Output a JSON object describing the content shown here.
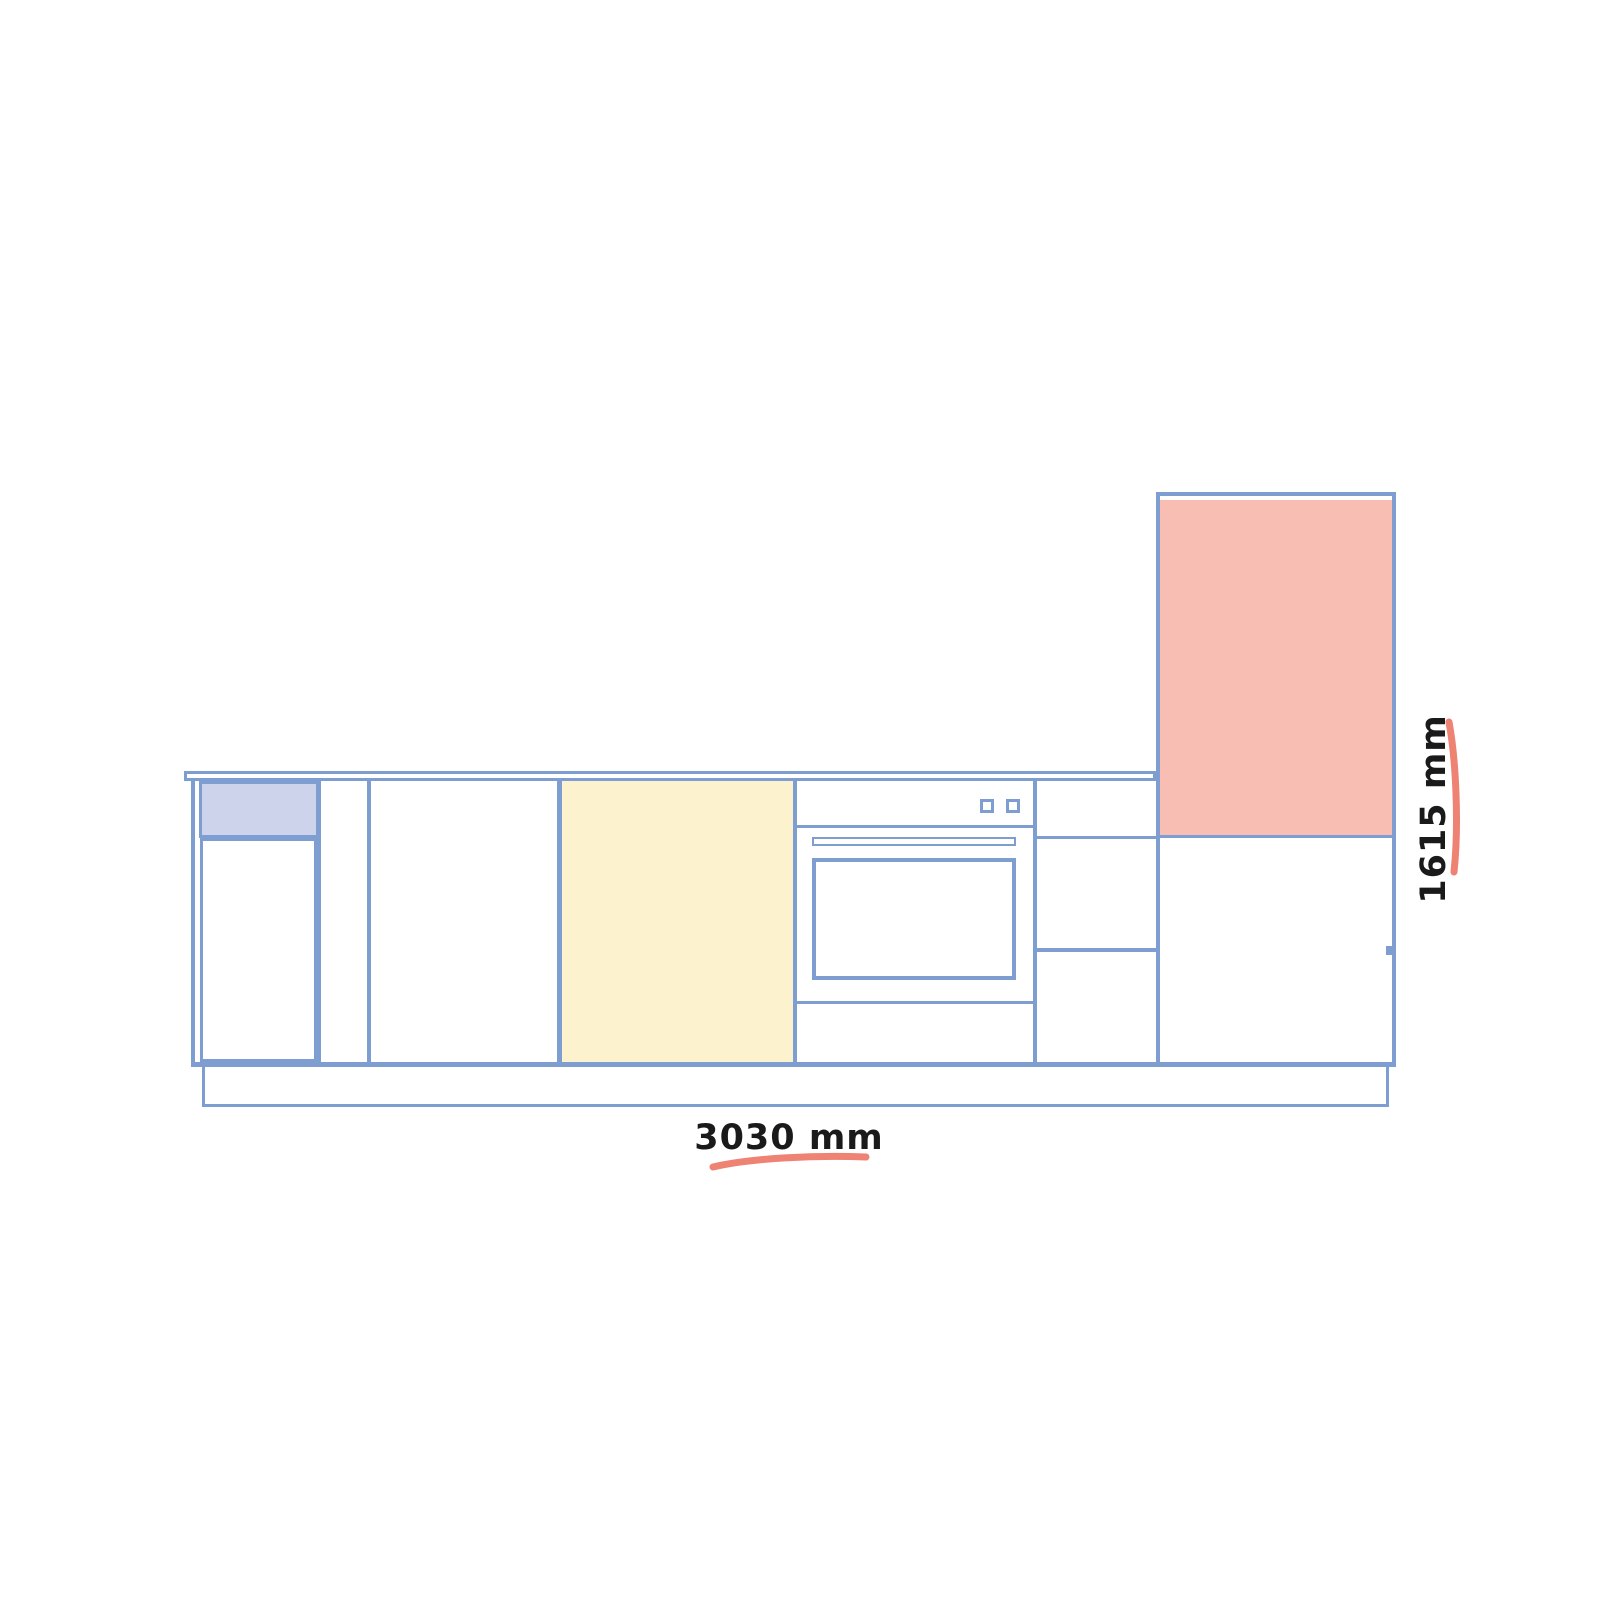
{
  "dimensions": {
    "width_label": "3030 mm",
    "height_label": "1615 mm"
  },
  "colors": {
    "outline_blue": "#7E9DD1",
    "highlight_lavender": "#CDD3EB",
    "highlight_yellow": "#FCF2CE",
    "highlight_pink": "#F8BDB3",
    "annotation_underline_red": "#EE8273",
    "dimension_text": "#1A1A1A",
    "background": "#FFFFFF"
  }
}
